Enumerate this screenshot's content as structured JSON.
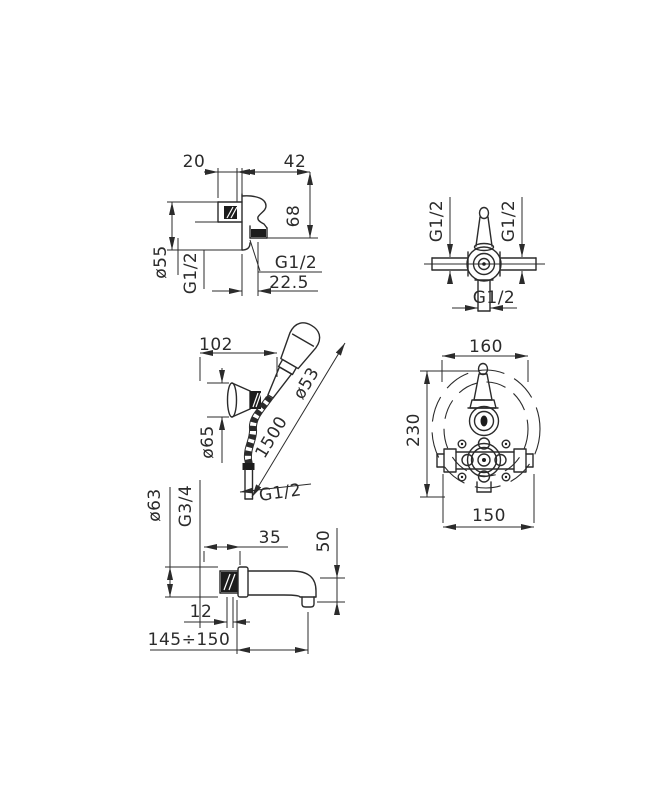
{
  "canvas": {
    "background": "#ffffff",
    "ink": "#2b2b2b"
  },
  "drawing": {
    "wall_union": {
      "dim_20": "20",
      "dim_42": "42",
      "dim_68": "68",
      "dia_body": "ø55",
      "thread_inlet": "G1/2",
      "thread_outlet": "G1/2",
      "dim_offset": "22.5"
    },
    "stop_valve": {
      "thread_left": "G1/2",
      "thread_right": "G1/2",
      "thread_bottom": "G1/2"
    },
    "hand_shower": {
      "dim_projection": "102",
      "dia_head": "ø53",
      "dia_bracket": "ø65",
      "hose_length": "1500",
      "thread_hose": "G1/2"
    },
    "thermostat": {
      "dim_width_top": "160",
      "dim_height": "230",
      "dim_width_bottom": "150"
    },
    "spout": {
      "dia_flange": "ø63",
      "thread": "G3/4",
      "dim_35": "35",
      "dim_50": "50",
      "dim_12": "12",
      "dim_reach": "145÷150"
    }
  }
}
